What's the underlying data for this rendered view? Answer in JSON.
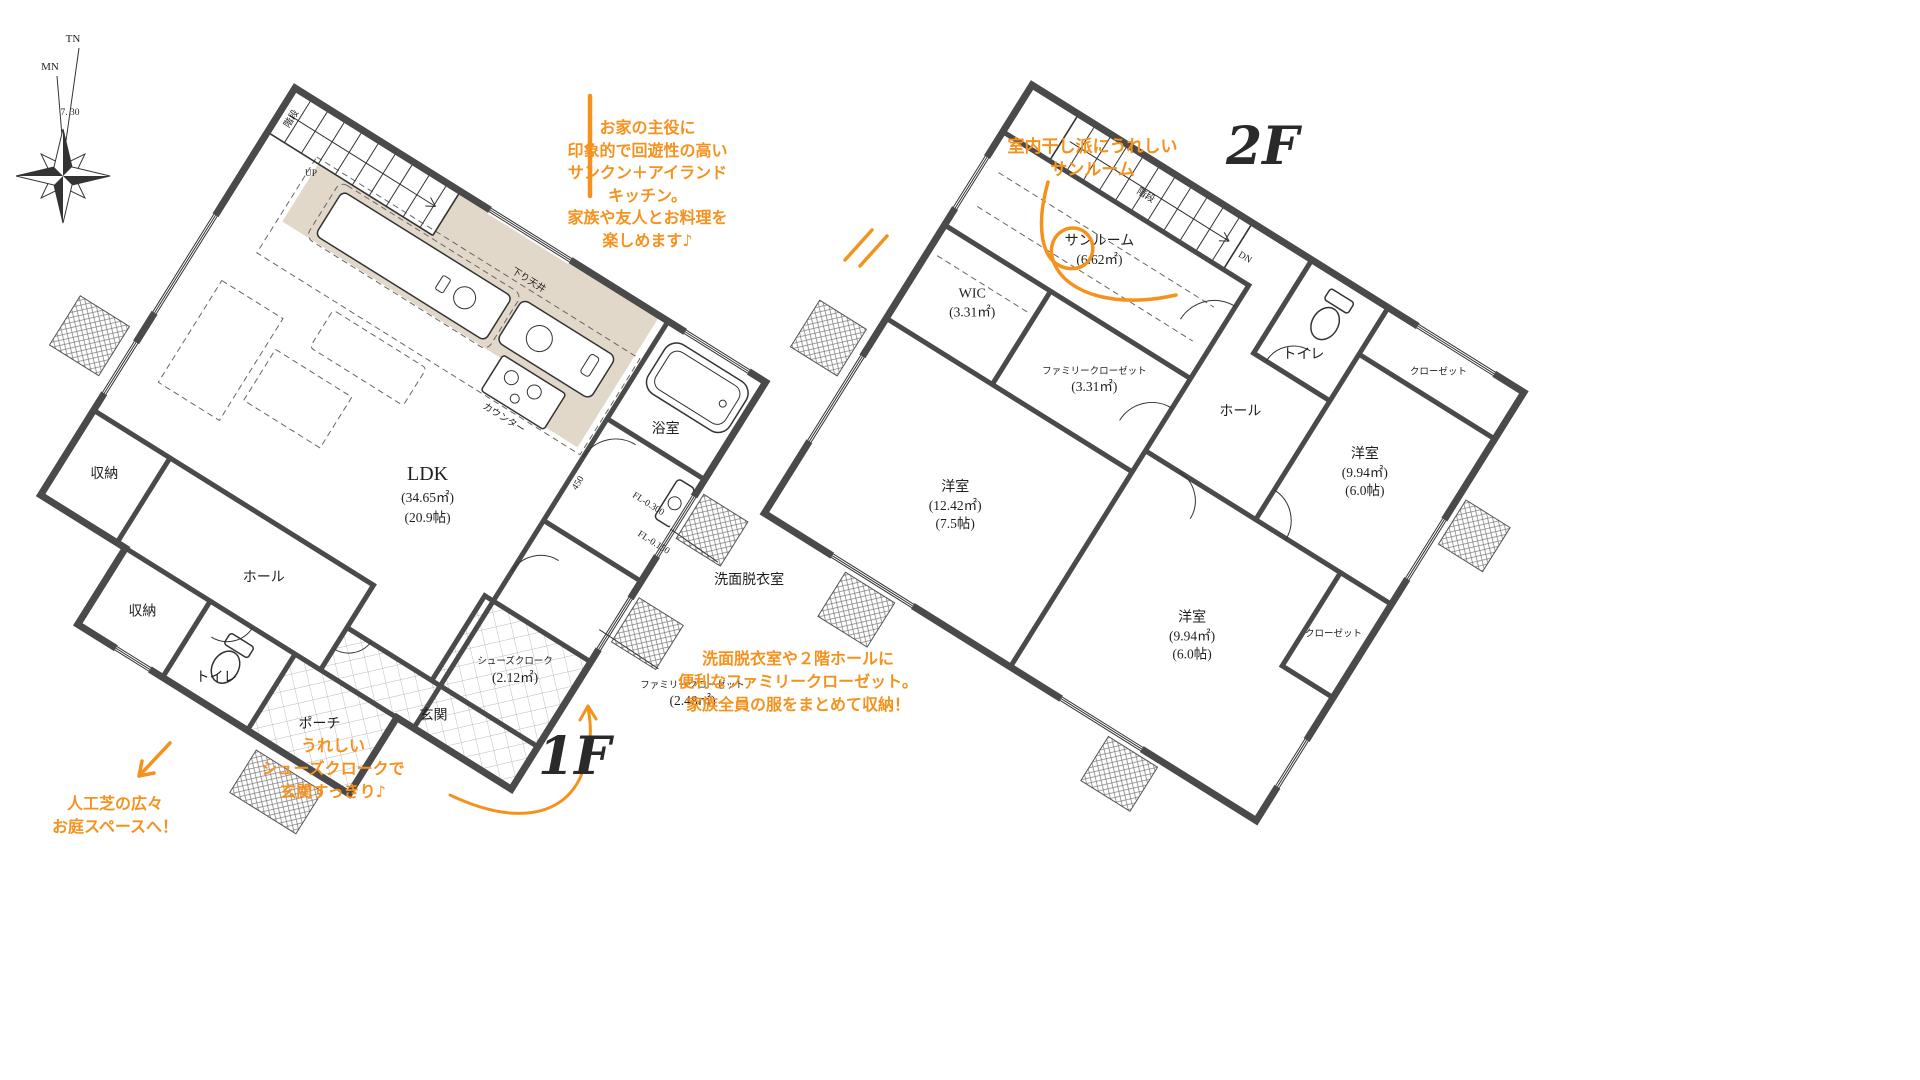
{
  "colors": {
    "accent_orange": "#F5921E",
    "kitchen_fill": "#E2D8C9",
    "wall": "#4A4A4A"
  },
  "compass": {
    "tn": "TN",
    "mn": "MN",
    "declination": "7. 30"
  },
  "floor1": {
    "label": "1F",
    "rooms": {
      "stairs": "階段",
      "up": "UP",
      "ldk": {
        "name": "LDK",
        "area_m2": "(34.65㎡)",
        "area_jo": "(20.9帖)"
      },
      "bath": "浴室",
      "washroom": "洗面脱衣室",
      "family_closet": {
        "name": "ファミリークローゼット",
        "area_m2": "(2.48㎡)"
      },
      "shoes_closet": {
        "name": "シューズクローク",
        "area_m2": "(2.12㎡)"
      },
      "entrance": "玄関",
      "porch": "ポーチ",
      "hall": "ホール",
      "toilet": "トイレ",
      "storage": "収納",
      "counter": "カウンター",
      "lowered_ceiling": "下り天井",
      "dim_450": "450",
      "fl_minus_300": "FL-0.300",
      "fl_minus_150": "FL-0.150"
    }
  },
  "floor2": {
    "label": "2F",
    "rooms": {
      "stairs": "階段",
      "dn": "DN",
      "sunroom": {
        "name": "サンルーム",
        "area_m2": "(6.62㎡)"
      },
      "wic": {
        "name": "WIC",
        "area_m2": "(3.31㎡)"
      },
      "family_closet": {
        "name": "ファミリークローゼット",
        "area_m2": "(3.31㎡)"
      },
      "hall": "ホール",
      "toilet": "トイレ",
      "closet": "クローゼット",
      "bedroom_right": {
        "name": "洋室",
        "area_m2": "(9.94㎡)",
        "area_jo": "(6.0帖)"
      },
      "bedroom_left": {
        "name": "洋室",
        "area_m2": "(12.42㎡)",
        "area_jo": "(7.5帖)"
      },
      "bedroom_bottom": {
        "name": "洋室",
        "area_m2": "(9.94㎡)",
        "area_jo": "(6.0帖)"
      }
    }
  },
  "annotations": {
    "kitchen_note": {
      "lines": [
        "お家の主役に",
        "印象的で回遊性の高い",
        "サンクン＋アイランド",
        "キッチン。",
        "家族や友人とお料理を",
        "楽しめます♪"
      ]
    },
    "sunroom_note": {
      "lines": [
        "室内干し派にうれしい",
        "サンルーム"
      ]
    },
    "garden_note": {
      "lines": [
        "人工芝の広々",
        "お庭スペースへ！"
      ]
    },
    "shoes_note": {
      "lines": [
        "うれしい",
        "シューズクロークで",
        "玄関すっきり♪"
      ]
    },
    "closet_note": {
      "lines": [
        "洗面脱衣室や２階ホールに",
        "便利なファミリークローゼット。",
        "家族全員の服をまとめて収納！"
      ]
    }
  }
}
